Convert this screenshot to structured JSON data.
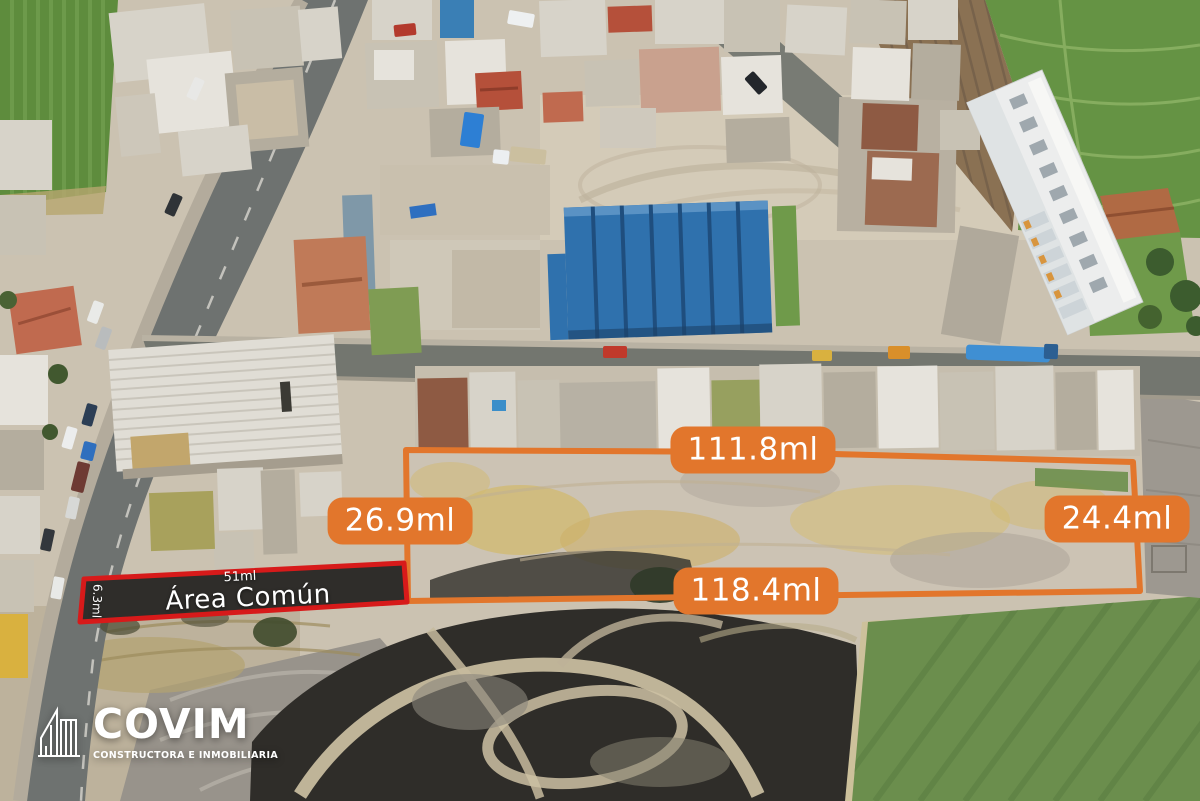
{
  "overlay": {
    "accent_orange": "#E2762C",
    "accent_red": "#D71A1A",
    "plot_measurements": {
      "top": "111.8ml",
      "left": "26.9ml",
      "right": "24.4ml",
      "bottom": "118.4ml"
    },
    "common_area": {
      "length_label": "51ml",
      "name": "Área Común",
      "width_label": "6.3ml"
    }
  },
  "branding": {
    "company": "COVIM",
    "tagline": "CONSTRUCTORA E INMOBILIARIA"
  }
}
